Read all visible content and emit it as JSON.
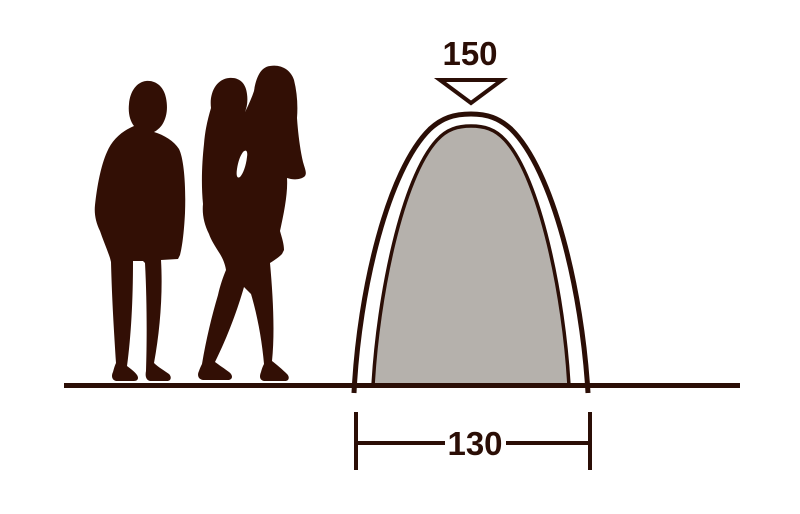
{
  "diagram": {
    "height_label": "150",
    "width_label": "130"
  },
  "colors": {
    "ink": "#2b0e06",
    "silhouette": "#320f05",
    "tent_fill": "#b5b1ac",
    "arrow_fill": "#ffffff",
    "background": "#ffffff"
  },
  "graphics": {
    "height_arrow_icon": "down-pointing-triangle",
    "tent_shape": "arched-dome-profile",
    "figures": [
      {
        "name": "adult-silhouette"
      },
      {
        "name": "adult-carrying-child-silhouette"
      }
    ],
    "ground": "baseline-rule"
  }
}
